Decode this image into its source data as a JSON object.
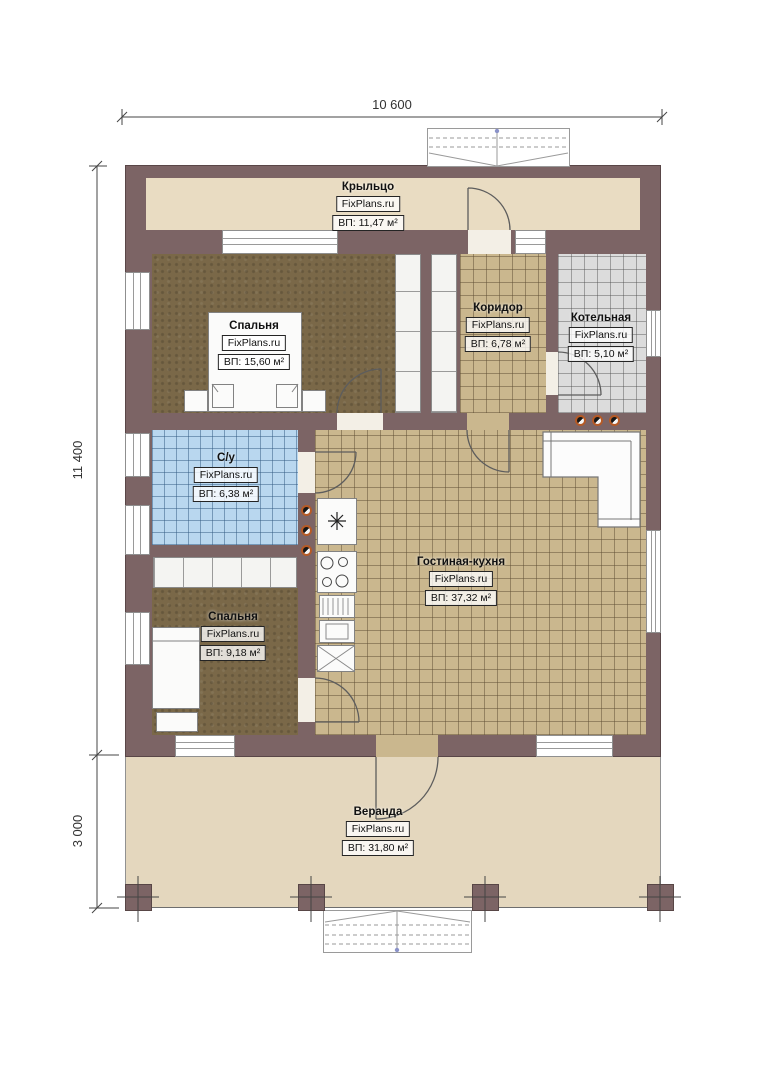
{
  "watermark": "FixPlans.ru",
  "dimensions": {
    "width_total": "10 600",
    "height_main": "11 400",
    "height_veranda": "3 000"
  },
  "rooms": {
    "porch": {
      "name": "Крыльцо",
      "area": "ВП: 11,47 м²"
    },
    "bedroom1": {
      "name": "Спальня",
      "area": "ВП: 15,60 м²"
    },
    "corridor": {
      "name": "Коридор",
      "area": "ВП: 6,78 м²"
    },
    "boiler": {
      "name": "Котельная",
      "area": "ВП: 5,10 м²"
    },
    "bathroom": {
      "name": "С/у",
      "area": "ВП: 6,38 м²"
    },
    "living": {
      "name": "Гостиная-кухня",
      "area": "ВП: 37,32 м²"
    },
    "bedroom2": {
      "name": "Спальня",
      "area": "ВП: 9,18 м²"
    },
    "veranda": {
      "name": "Веранда",
      "area": "ВП: 31,80 м²"
    }
  },
  "colors": {
    "wall": "#7c6465",
    "porch_floor": "#e9dcc2",
    "veranda_floor": "#e4d7be",
    "tile_tan": "#cab78e",
    "tile_gray": "#dcdcdc",
    "tile_blue": "#b9d7ef",
    "bedroom_floor": "#7a6848",
    "vent_dot_ring": "#b55a26"
  }
}
